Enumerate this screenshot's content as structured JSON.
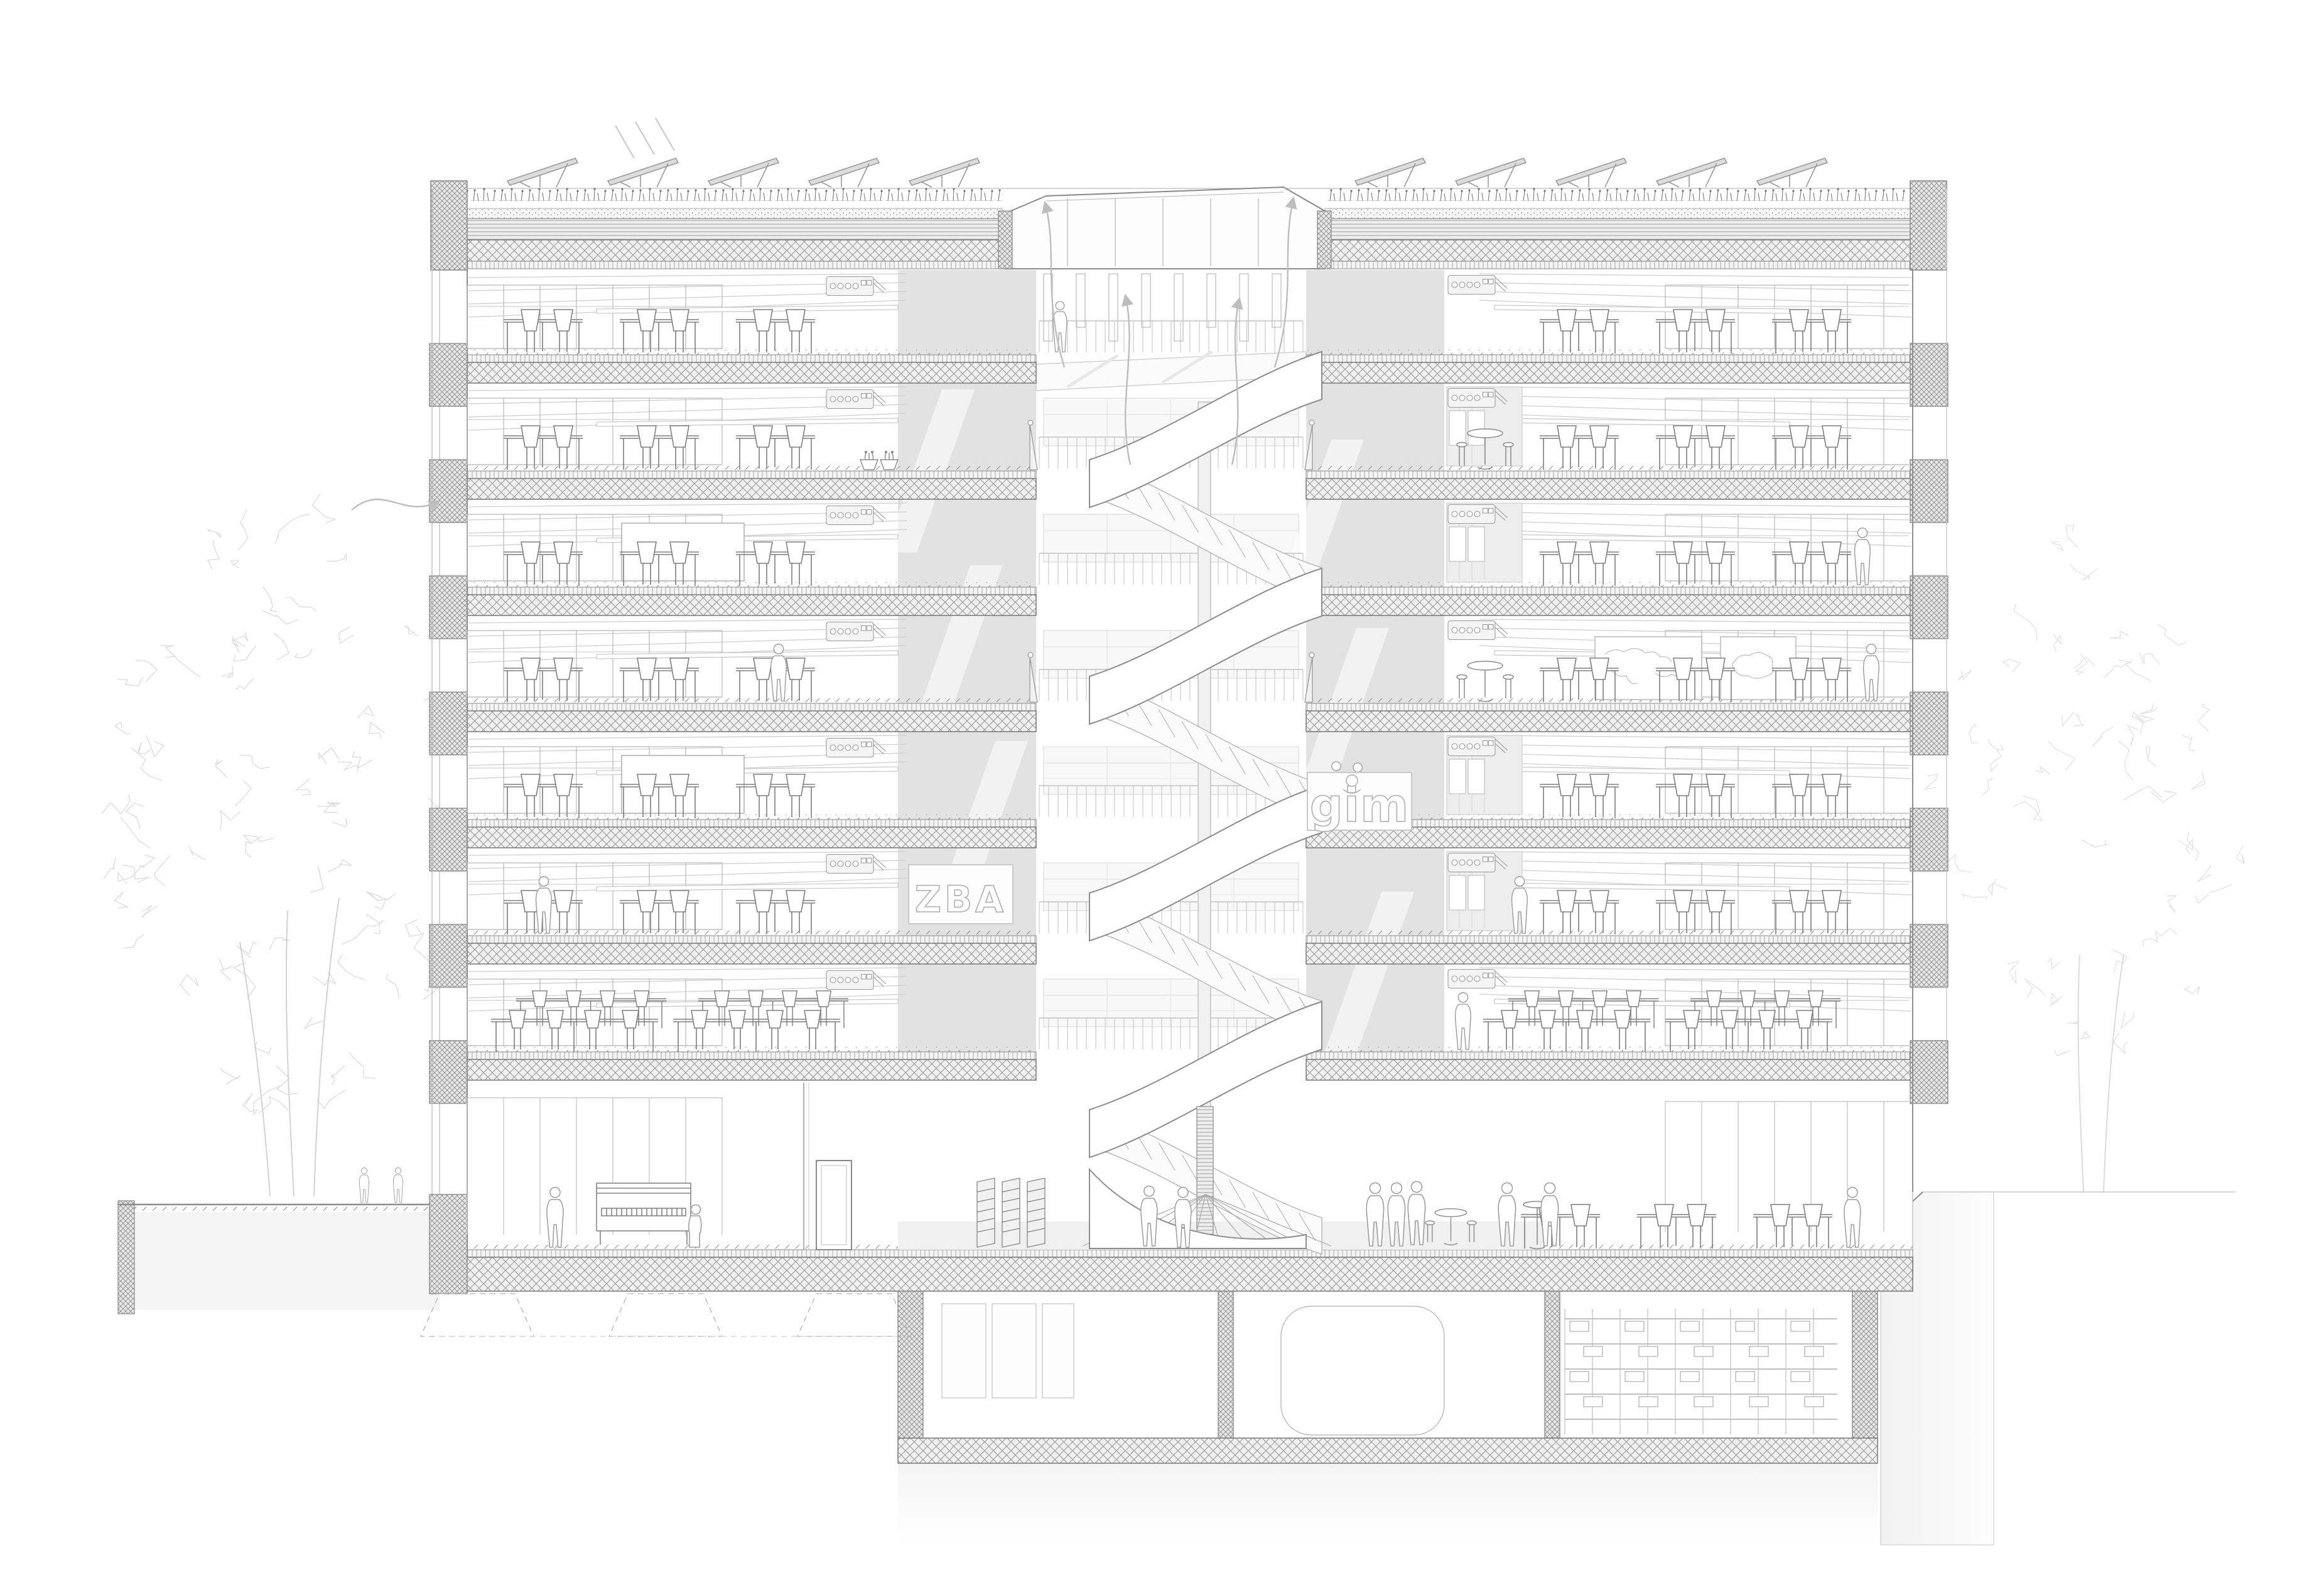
{
  "drawing": {
    "title": "building-cross-section",
    "signs": {
      "zba": "ZBA",
      "gim": "gim"
    },
    "floors": {
      "above_ground_levels": 8,
      "basement_levels": 1
    },
    "palette": {
      "background": "#ffffff",
      "line_dark": "#5f5f5f",
      "line_mid": "#8c8c8c",
      "line_light": "#b5b5b5",
      "line_faint": "#d7d7d7",
      "atrium_wall": "#e2e2e2",
      "glass_tint": "#f6f6f6",
      "earth": "#f4f4f4",
      "solar_panel": "#dcdcdc"
    },
    "glyphs": [
      "spiral-staircase-icon",
      "green-roof-icon",
      "solar-panel-icon",
      "roof-skylight-icon",
      "classroom-desk-icon",
      "long-table-icon",
      "round-table-icon",
      "standing-table-icon",
      "person-silhouette-icon",
      "piano-icon",
      "storage-rack-icon",
      "tree-sketch-icon",
      "ventilation-arrow-icon",
      "whiteboard-icon",
      "world-map-icon",
      "switzerland-map-icon",
      "plant-pot-icon",
      "stacked-chairs-icon",
      "vent-unit-icon"
    ]
  }
}
